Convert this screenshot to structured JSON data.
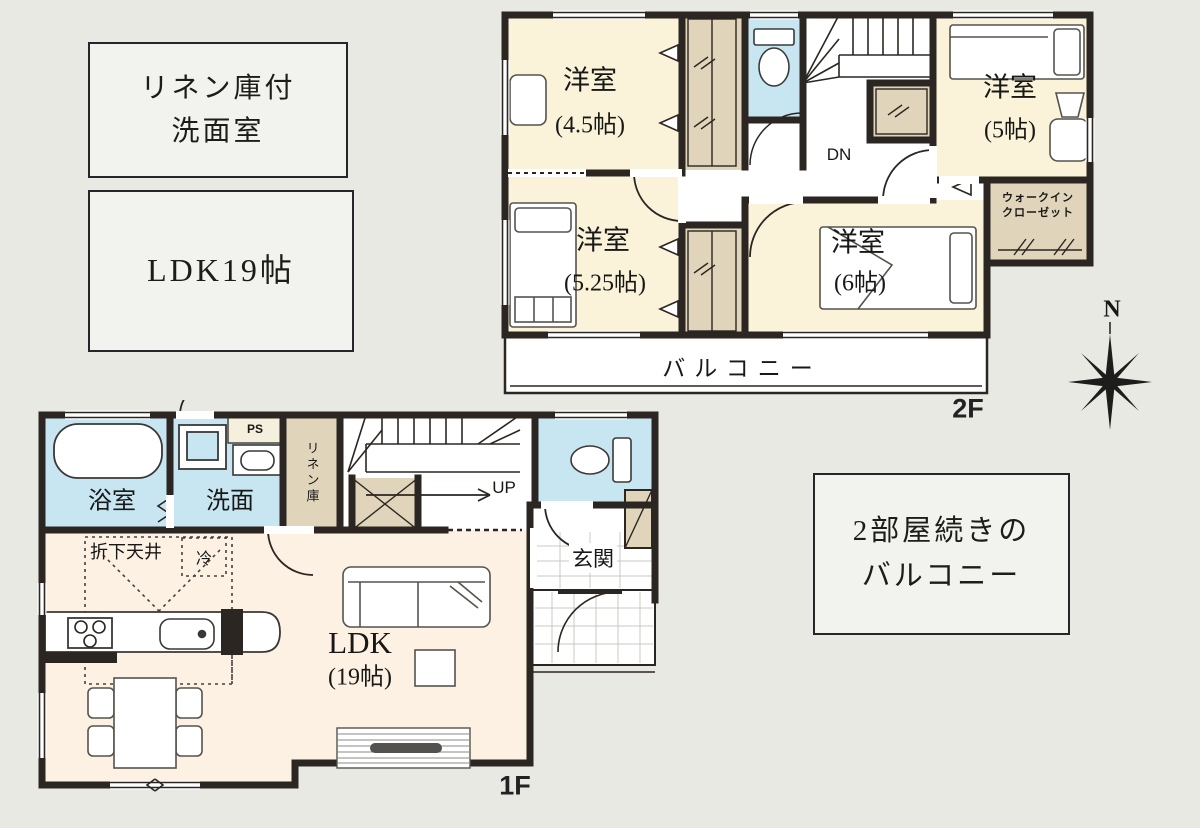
{
  "annotation_boxes": {
    "linen_washroom": {
      "line1": "リネン庫付",
      "line2": "洗面室"
    },
    "ldk_size": {
      "text": "LDK19帖"
    },
    "balcony_note": {
      "line1": "2部屋続きの",
      "line2": "バルコニー"
    }
  },
  "floor_2f": {
    "floor_label": "2F",
    "room_45": {
      "name": "洋室",
      "size": "(4.5帖)"
    },
    "room_5": {
      "name": "洋室",
      "size": "(5帖)"
    },
    "room_525": {
      "name": "洋室",
      "size": "(5.25帖)"
    },
    "room_6": {
      "name": "洋室",
      "size": "(6帖)"
    },
    "balcony": {
      "name": "バルコニー"
    },
    "wic": {
      "line1": "ウォークイン",
      "line2": "クローゼット",
      "hanger_marks": "〃　　〃"
    },
    "stairs": {
      "label": "DN"
    }
  },
  "floor_1f": {
    "floor_label": "1F",
    "bath": {
      "name": "浴室"
    },
    "washroom": {
      "name": "洗面"
    },
    "ps": {
      "label": "PS"
    },
    "linen_closet": {
      "name": "リネン庫"
    },
    "stairs": {
      "label": "UP"
    },
    "entrance": {
      "name": "玄関"
    },
    "ldk": {
      "name": "LDK",
      "size": "(19帖)"
    },
    "lowered_ceiling": {
      "name": "折下天井"
    },
    "refrigerator": {
      "label": "冷"
    }
  },
  "compass": {
    "north": "N"
  },
  "colors": {
    "wall": "#2b2622",
    "room_cream": "#faf3da",
    "ldk_cream": "#fcf1e2",
    "wet_blue": "#c8e6f2",
    "closet_tan": "#e0d5ba",
    "background": "#e8e9e3"
  }
}
